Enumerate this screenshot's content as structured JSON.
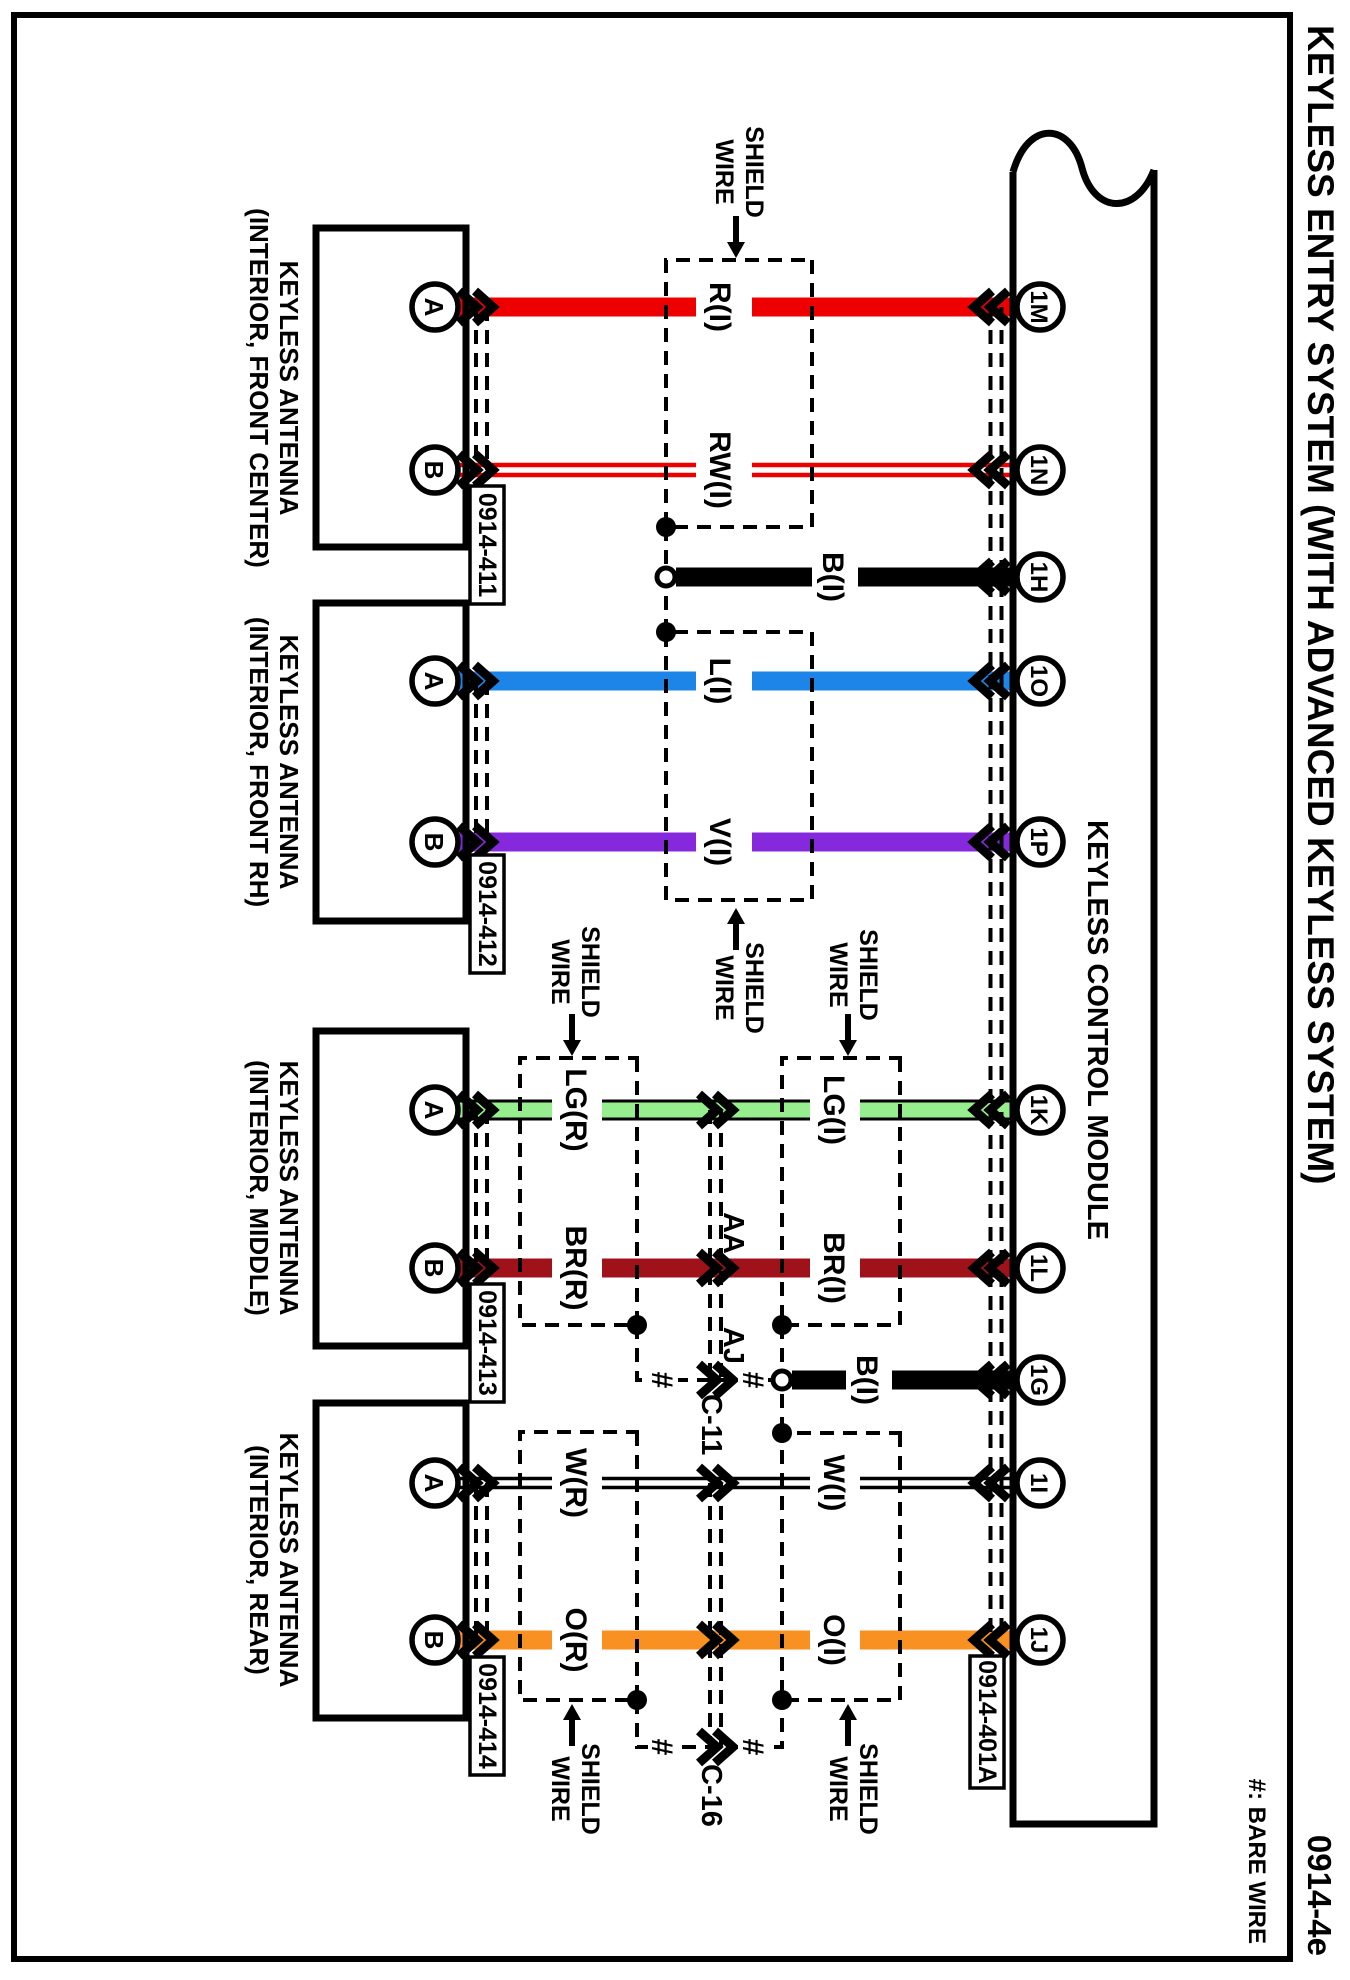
{
  "title": "KEYLESS ENTRY SYSTEM (WITH ADVANCED KEYLESS SYSTEM)",
  "page_code": "0914-4e",
  "legend": {
    "bare_wire_note": "#: BARE WIRE",
    "bare_symbol": "#",
    "shield_line1": "SHIELD",
    "shield_line2": "WIRE"
  },
  "module": {
    "name": "KEYLESS CONTROL MODULE",
    "connector": "0914-401A",
    "pins": [
      "1M",
      "1N",
      "1H",
      "1O",
      "1P",
      "1K",
      "1L",
      "1G",
      "1I",
      "1J"
    ]
  },
  "antennas": [
    {
      "line1": "KEYLESS ANTENNA",
      "line2": "(INTERIOR, FRONT CENTER)",
      "connector": "0914-411",
      "pin_a": "A",
      "pin_b": "B"
    },
    {
      "line1": "KEYLESS ANTENNA",
      "line2": "(INTERIOR, FRONT RH)",
      "connector": "0914-412",
      "pin_a": "A",
      "pin_b": "B"
    },
    {
      "line1": "KEYLESS ANTENNA",
      "line2": "(INTERIOR, MIDDLE)",
      "connector": "0914-413",
      "pin_a": "A",
      "pin_b": "B"
    },
    {
      "line1": "KEYLESS ANTENNA",
      "line2": "(INTERIOR, REAR)",
      "connector": "0914-414",
      "pin_a": "A",
      "pin_b": "B"
    }
  ],
  "wires": {
    "r": "R(I)",
    "rw": "RW(I)",
    "b1": "B(I)",
    "l": "L(I)",
    "v": "V(I)",
    "lg_r": "LG(R)",
    "lg_i": "LG(I)",
    "br_r": "BR(R)",
    "br_i": "BR(I)",
    "b2": "B(I)",
    "w_r": "W(R)",
    "w_i": "W(I)",
    "o_r": "O(R)",
    "o_i": "O(I)"
  },
  "connectors": {
    "c11": {
      "name": "C-11",
      "pin_br": "AA",
      "pin_shield": "AJ"
    },
    "c16": {
      "name": "C-16"
    }
  },
  "colors": {
    "red": "#ee0000",
    "blue": "#1d84e8",
    "purple": "#8629dd",
    "light_green": "#97ee8e",
    "dark_red": "#a0121a",
    "orange": "#f89022",
    "black": "#000000"
  }
}
